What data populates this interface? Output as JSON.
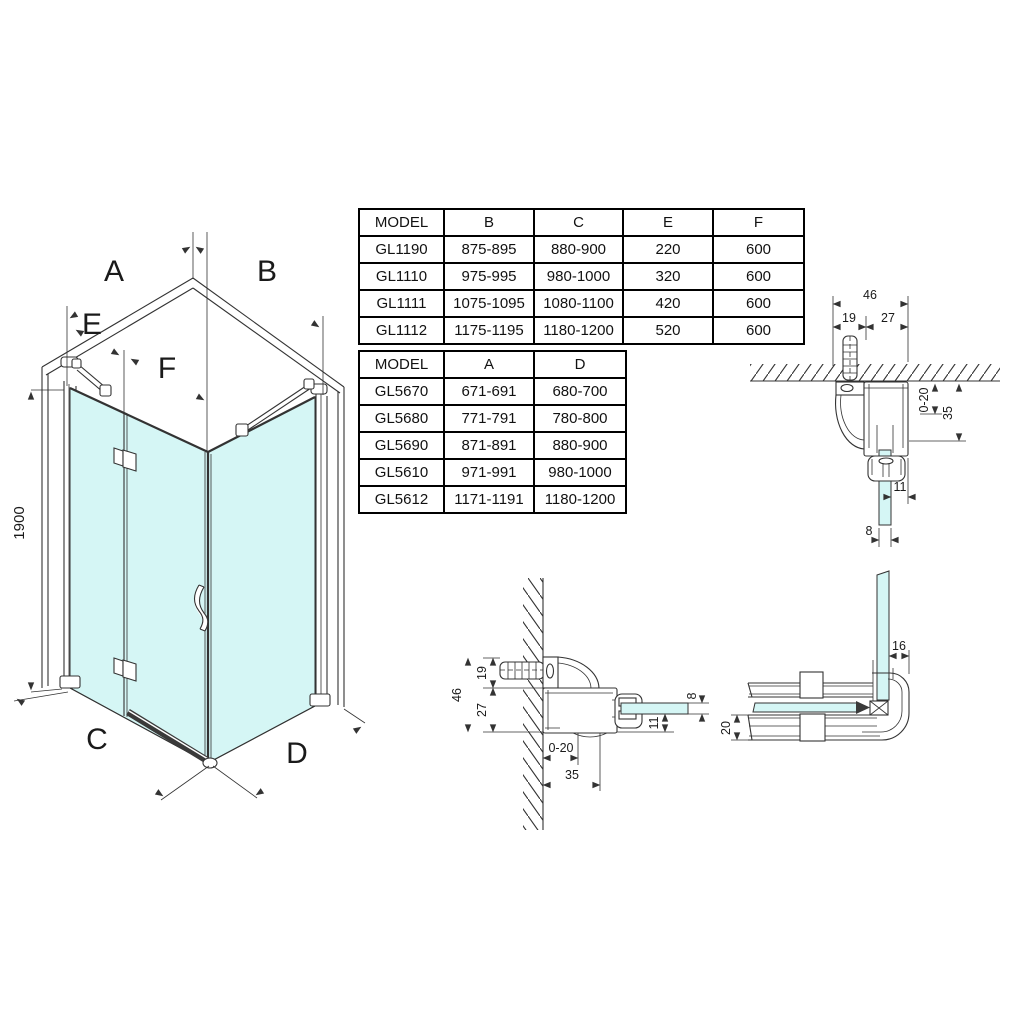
{
  "colors": {
    "glass": "#d5f6f5",
    "line": "#333333",
    "table_border": "#000000"
  },
  "iso": {
    "labels": {
      "a": "A",
      "b": "B",
      "c": "C",
      "d": "D",
      "e": "E",
      "f": "F"
    },
    "height": "1900"
  },
  "wall_profile": {
    "w46": "46",
    "w19": "19",
    "w27": "27",
    "adj": "0-20",
    "d35": "35",
    "d11": "11",
    "d8": "8"
  },
  "corner": {
    "d16": "16",
    "d20": "20"
  },
  "tables": {
    "t1": {
      "headers": [
        "MODEL",
        "B",
        "C",
        "E",
        "F"
      ],
      "rows": [
        [
          "GL1190",
          "875-895",
          "880-900",
          "220",
          "600"
        ],
        [
          "GL1110",
          "975-995",
          "980-1000",
          "320",
          "600"
        ],
        [
          "GL1111",
          "1075-1095",
          "1080-1100",
          "420",
          "600"
        ],
        [
          "GL1112",
          "1175-1195",
          "1180-1200",
          "520",
          "600"
        ]
      ]
    },
    "t2": {
      "headers": [
        "MODEL",
        "A",
        "D"
      ],
      "rows": [
        [
          "GL5670",
          "671-691",
          "680-700"
        ],
        [
          "GL5680",
          "771-791",
          "780-800"
        ],
        [
          "GL5690",
          "871-891",
          "880-900"
        ],
        [
          "GL5610",
          "971-991",
          "980-1000"
        ],
        [
          "GL5612",
          "1171-1191",
          "1180-1200"
        ]
      ]
    }
  }
}
